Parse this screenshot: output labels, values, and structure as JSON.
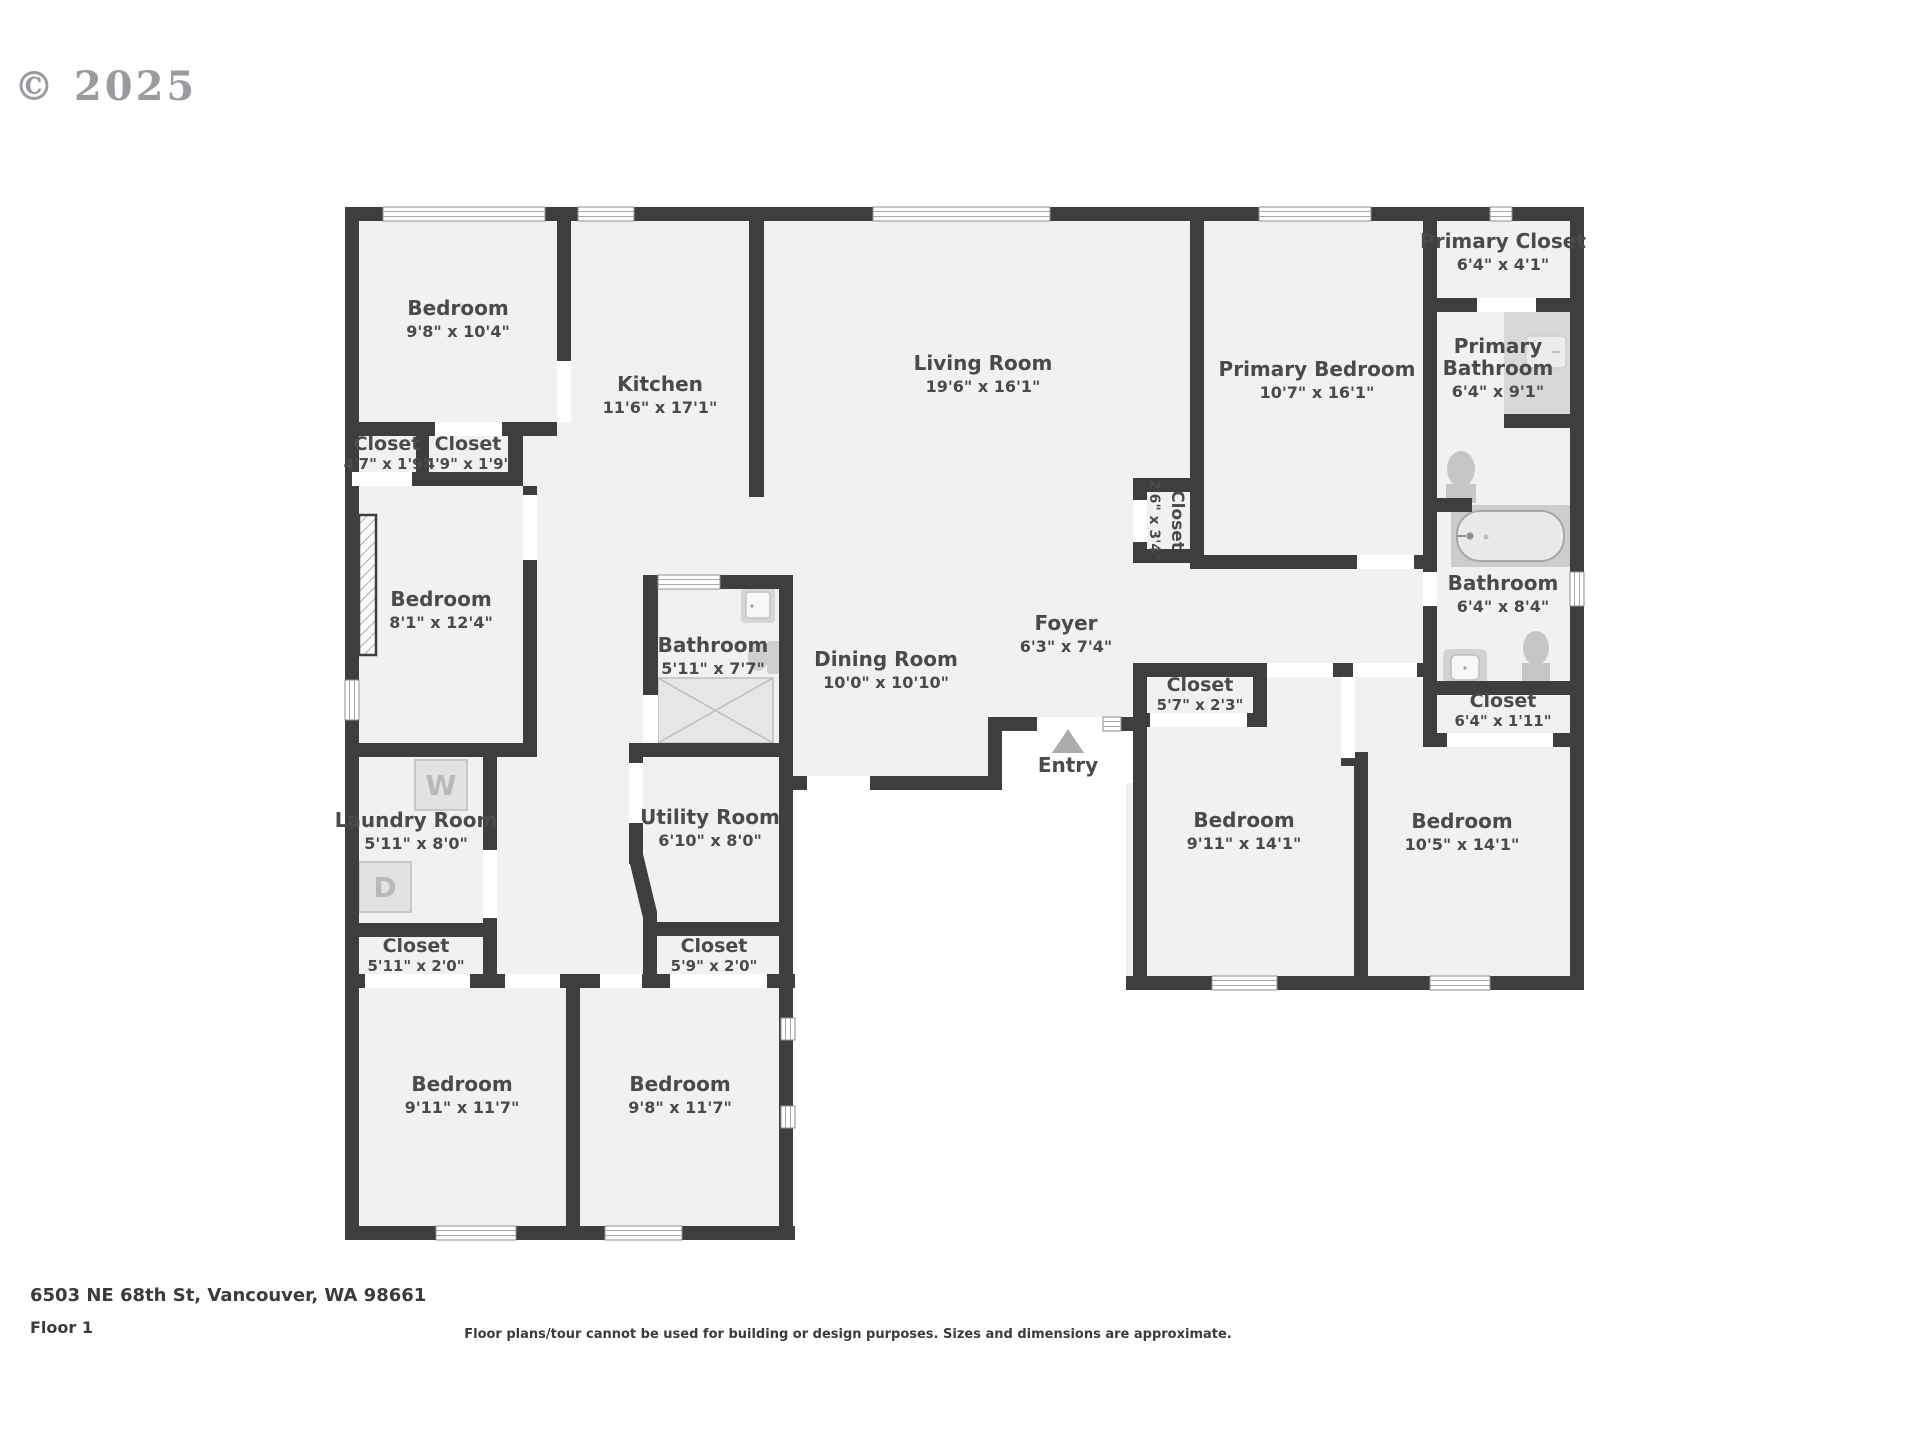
{
  "watermark": "© 2025",
  "footer": {
    "address": "6503 NE 68th St, Vancouver, WA 98661",
    "floor_label": "Floor 1",
    "disclaimer": "Floor plans/tour cannot be used for building or design purposes. Sizes and dimensions are approximate."
  },
  "fixtures": {
    "washer": "W",
    "dryer": "D"
  },
  "colors": {
    "wall": "#3e3e3e",
    "floor": "#f1f1f1",
    "fixture_gray": "#cdcdcd",
    "label_text": "#4a4a4a"
  },
  "rooms": [
    {
      "name": "Bedroom",
      "dims": "9'8\" x 10'4\""
    },
    {
      "name": "Kitchen",
      "dims": "11'6\" x 17'1\""
    },
    {
      "name": "Living Room",
      "dims": "19'6\" x 16'1\""
    },
    {
      "name": "Primary Bedroom",
      "dims": "10'7\" x 16'1\""
    },
    {
      "name": "Primary Closet",
      "dims": "6'4\" x 4'1\""
    },
    {
      "name": "Primary",
      "name2": "Bathroom",
      "dims": "6'4\" x 9'1\""
    },
    {
      "name": "Bathroom",
      "dims": "6'4\" x 8'4\""
    },
    {
      "name": "Closet",
      "dims": "6'4\" x 1'11\""
    },
    {
      "name": "Closet",
      "dims": "2'6\" x 3'4\""
    },
    {
      "name": "Closet",
      "dims": "4'7\" x 1'9\""
    },
    {
      "name": "Closet",
      "dims": "4'9\" x 1'9\""
    },
    {
      "name": "Bedroom",
      "dims": "8'1\" x 12'4\""
    },
    {
      "name": "Bathroom",
      "dims": "5'11\" x 7'7\""
    },
    {
      "name": "Dining Room",
      "dims": "10'0\" x 10'10\""
    },
    {
      "name": "Foyer",
      "dims": "6'3\" x 7'4\""
    },
    {
      "name": "Closet",
      "dims": "5'7\" x 2'3\""
    },
    {
      "name": "Laundry Room",
      "dims": "5'11\" x 8'0\""
    },
    {
      "name": "Utility Room",
      "dims": "6'10\" x 8'0\""
    },
    {
      "name": "Closet",
      "dims": "5'11\" x 2'0\""
    },
    {
      "name": "Closet",
      "dims": "5'9\" x 2'0\""
    },
    {
      "name": "Bedroom",
      "dims": "9'11\" x 11'7\""
    },
    {
      "name": "Bedroom",
      "dims": "9'8\" x 11'7\""
    },
    {
      "name": "Bedroom",
      "dims": "9'11\" x 14'1\""
    },
    {
      "name": "Bedroom",
      "dims": "10'5\" x 14'1\""
    },
    {
      "name": "Entry"
    }
  ]
}
